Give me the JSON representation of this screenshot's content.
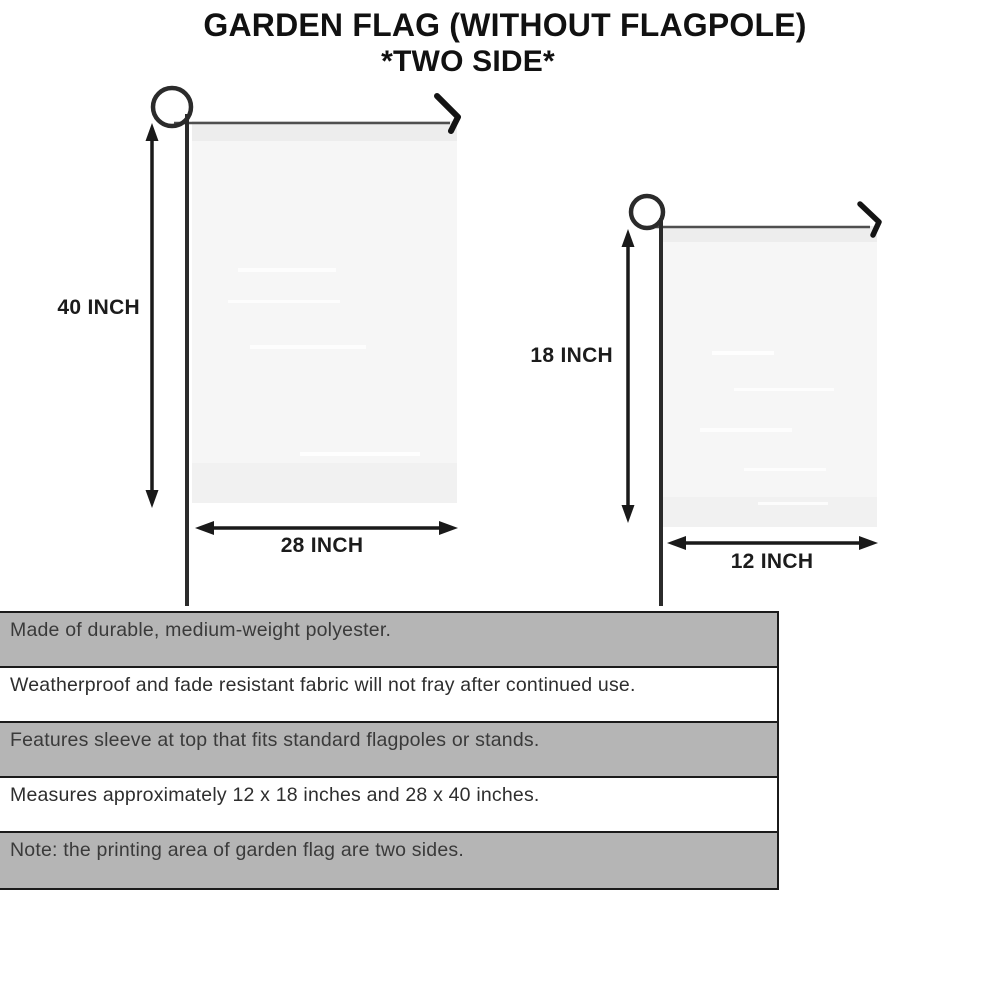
{
  "title": {
    "line1": "GARDEN FLAG (WITHOUT FLAGPOLE)",
    "line2": "*TWO SIDE*"
  },
  "diagram": {
    "large_flag": {
      "name": "large garden flag",
      "height_label": "40 INCH",
      "width_label": "28 INCH"
    },
    "small_flag": {
      "name": "small garden flag",
      "height_label": "18 INCH",
      "width_label": "12 INCH"
    }
  },
  "features": {
    "rows": [
      {
        "text": "Made of durable, medium-weight polyester."
      },
      {
        "text": "Weatherproof and fade resistant fabric will not fray after continued use."
      },
      {
        "text": "Features sleeve at top that fits standard flagpoles or stands."
      },
      {
        "text": "Measures approximately 12 x 18 inches and 28 x 40 inches."
      },
      {
        "text": "Note: the printing area of garden flag are two sides."
      }
    ]
  },
  "colors": {
    "row_shaded": "#b5b5b5",
    "row_plain": "#ffffff",
    "table_border": "#1b1b1b",
    "flag_fill": "#f6f6f6",
    "flag_sleeve": "#ededed",
    "pole": "#2b2b2b",
    "arrow_ink": "#1a1a1a",
    "title_ink": "#111111"
  }
}
